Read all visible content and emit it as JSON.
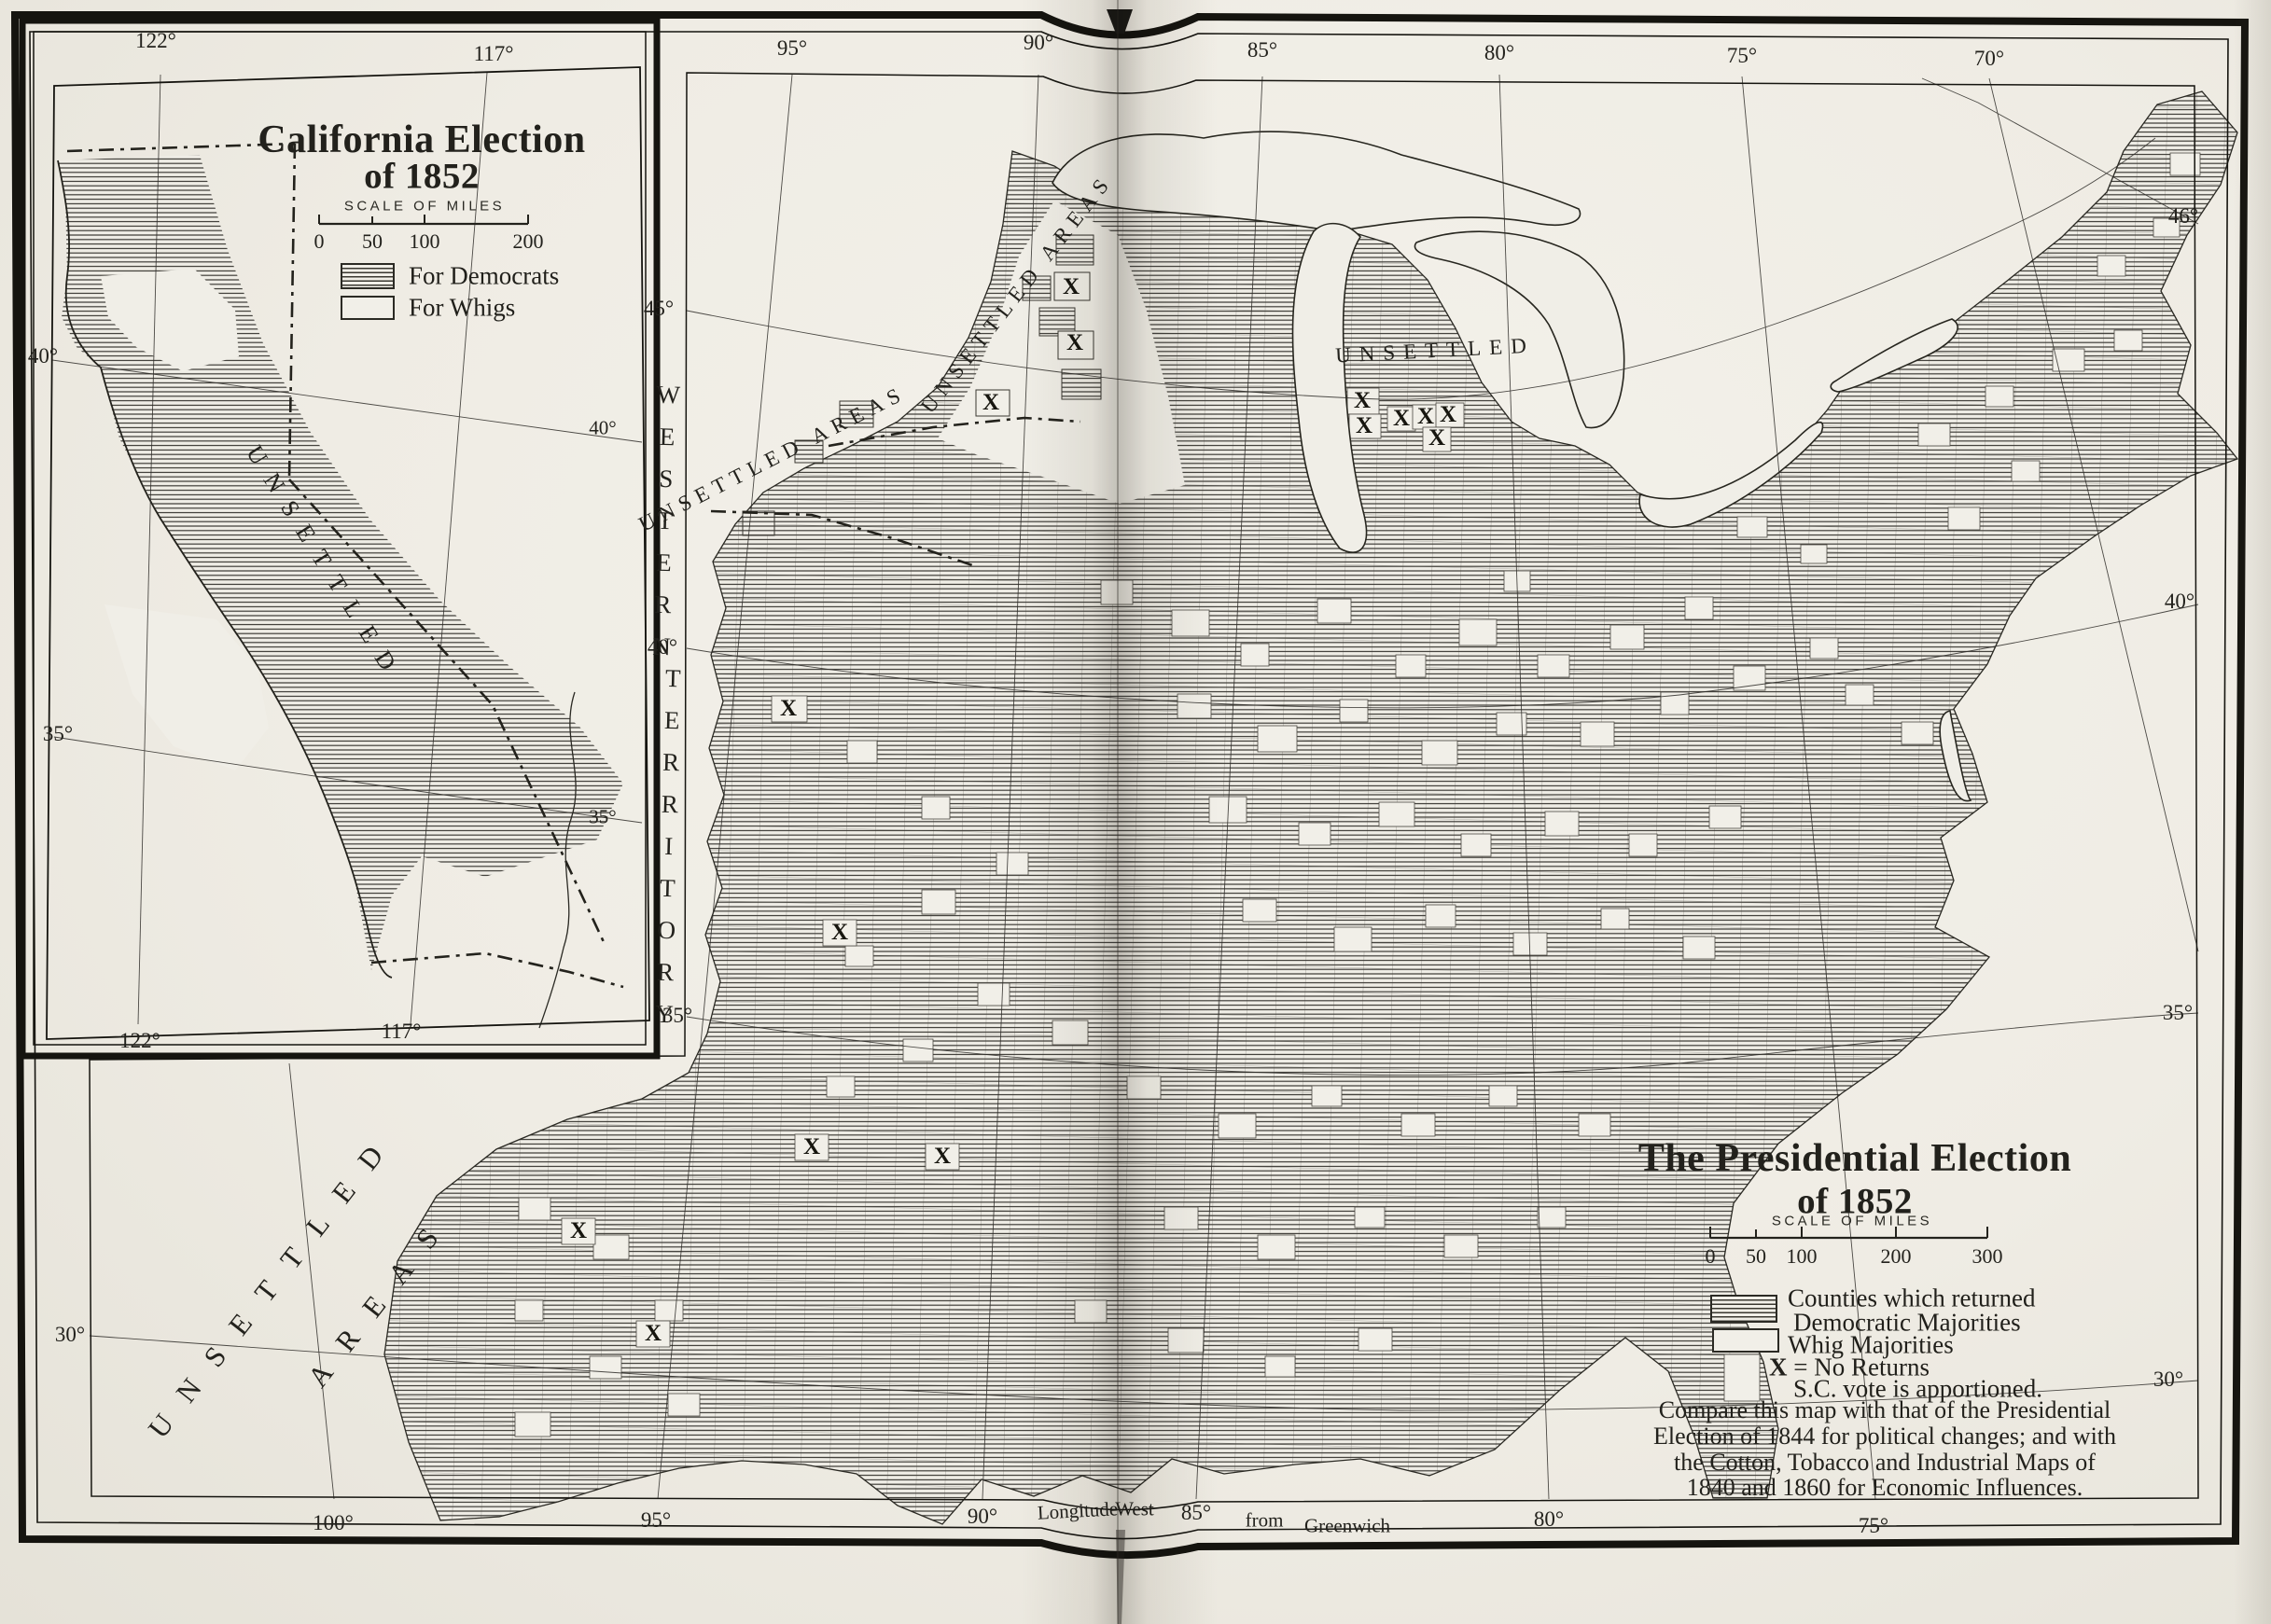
{
  "colors": {
    "paper": "#f1efe8",
    "ink": "#201f1a",
    "hatch_ink": "#34322d"
  },
  "inset": {
    "title_line1": "California Election",
    "title_line2": "of 1852",
    "scale_label": "Scale of Miles",
    "scale_ticks": [
      "0",
      "50",
      "100",
      "200"
    ],
    "legend": {
      "democrats": "For Democrats",
      "whigs": "For Whigs"
    },
    "region_label": "UNSETTLED",
    "graticule": {
      "top": [
        "122°",
        "117°"
      ],
      "left": [
        "40°",
        "35°"
      ],
      "bottom": [
        "122°",
        "117°"
      ],
      "inner": [
        "40°",
        "35°"
      ]
    }
  },
  "main_map": {
    "title_line1": "The Presidential Election",
    "title_line2": "of 1852",
    "scale_label": "Scale of Miles",
    "scale_ticks": [
      "0",
      "50",
      "100",
      "200",
      "300"
    ],
    "legend": {
      "democratic_line1": "Counties which returned",
      "democratic_line2": "Democratic Majorities",
      "whig": "Whig Majorities",
      "no_returns_symbol": "X",
      "no_returns_text": "= No Returns",
      "apportioned_note": "S.C. vote is apportioned."
    },
    "note_lines": [
      "Compare this map with that of the Presidential",
      "Election of 1844 for political changes; and with",
      "the Cotton, Tobacco and Industrial Maps of",
      "1840 and 1860 for Economic Influences."
    ],
    "labels": {
      "western": "WESTERN",
      "territory": "TERRITORY",
      "unsettled_areas": "UNSETTLED AREAS",
      "unsettled": "UNSETTLED",
      "areas": "AREAS"
    },
    "graticule": {
      "top": [
        "95°",
        "90°",
        "85°",
        "80°",
        "75°",
        "70°"
      ],
      "bottom": [
        "100°",
        "95°",
        "90°",
        "85°",
        "80°",
        "75°"
      ],
      "bottom_words": {
        "longitude": "Longitude",
        "west": "West",
        "from": "from",
        "greenwich": "Greenwich"
      },
      "left": [
        "45°",
        "40°",
        "35°",
        "30°"
      ],
      "right": [
        "46°",
        "40°",
        "35°",
        "30°"
      ]
    }
  }
}
